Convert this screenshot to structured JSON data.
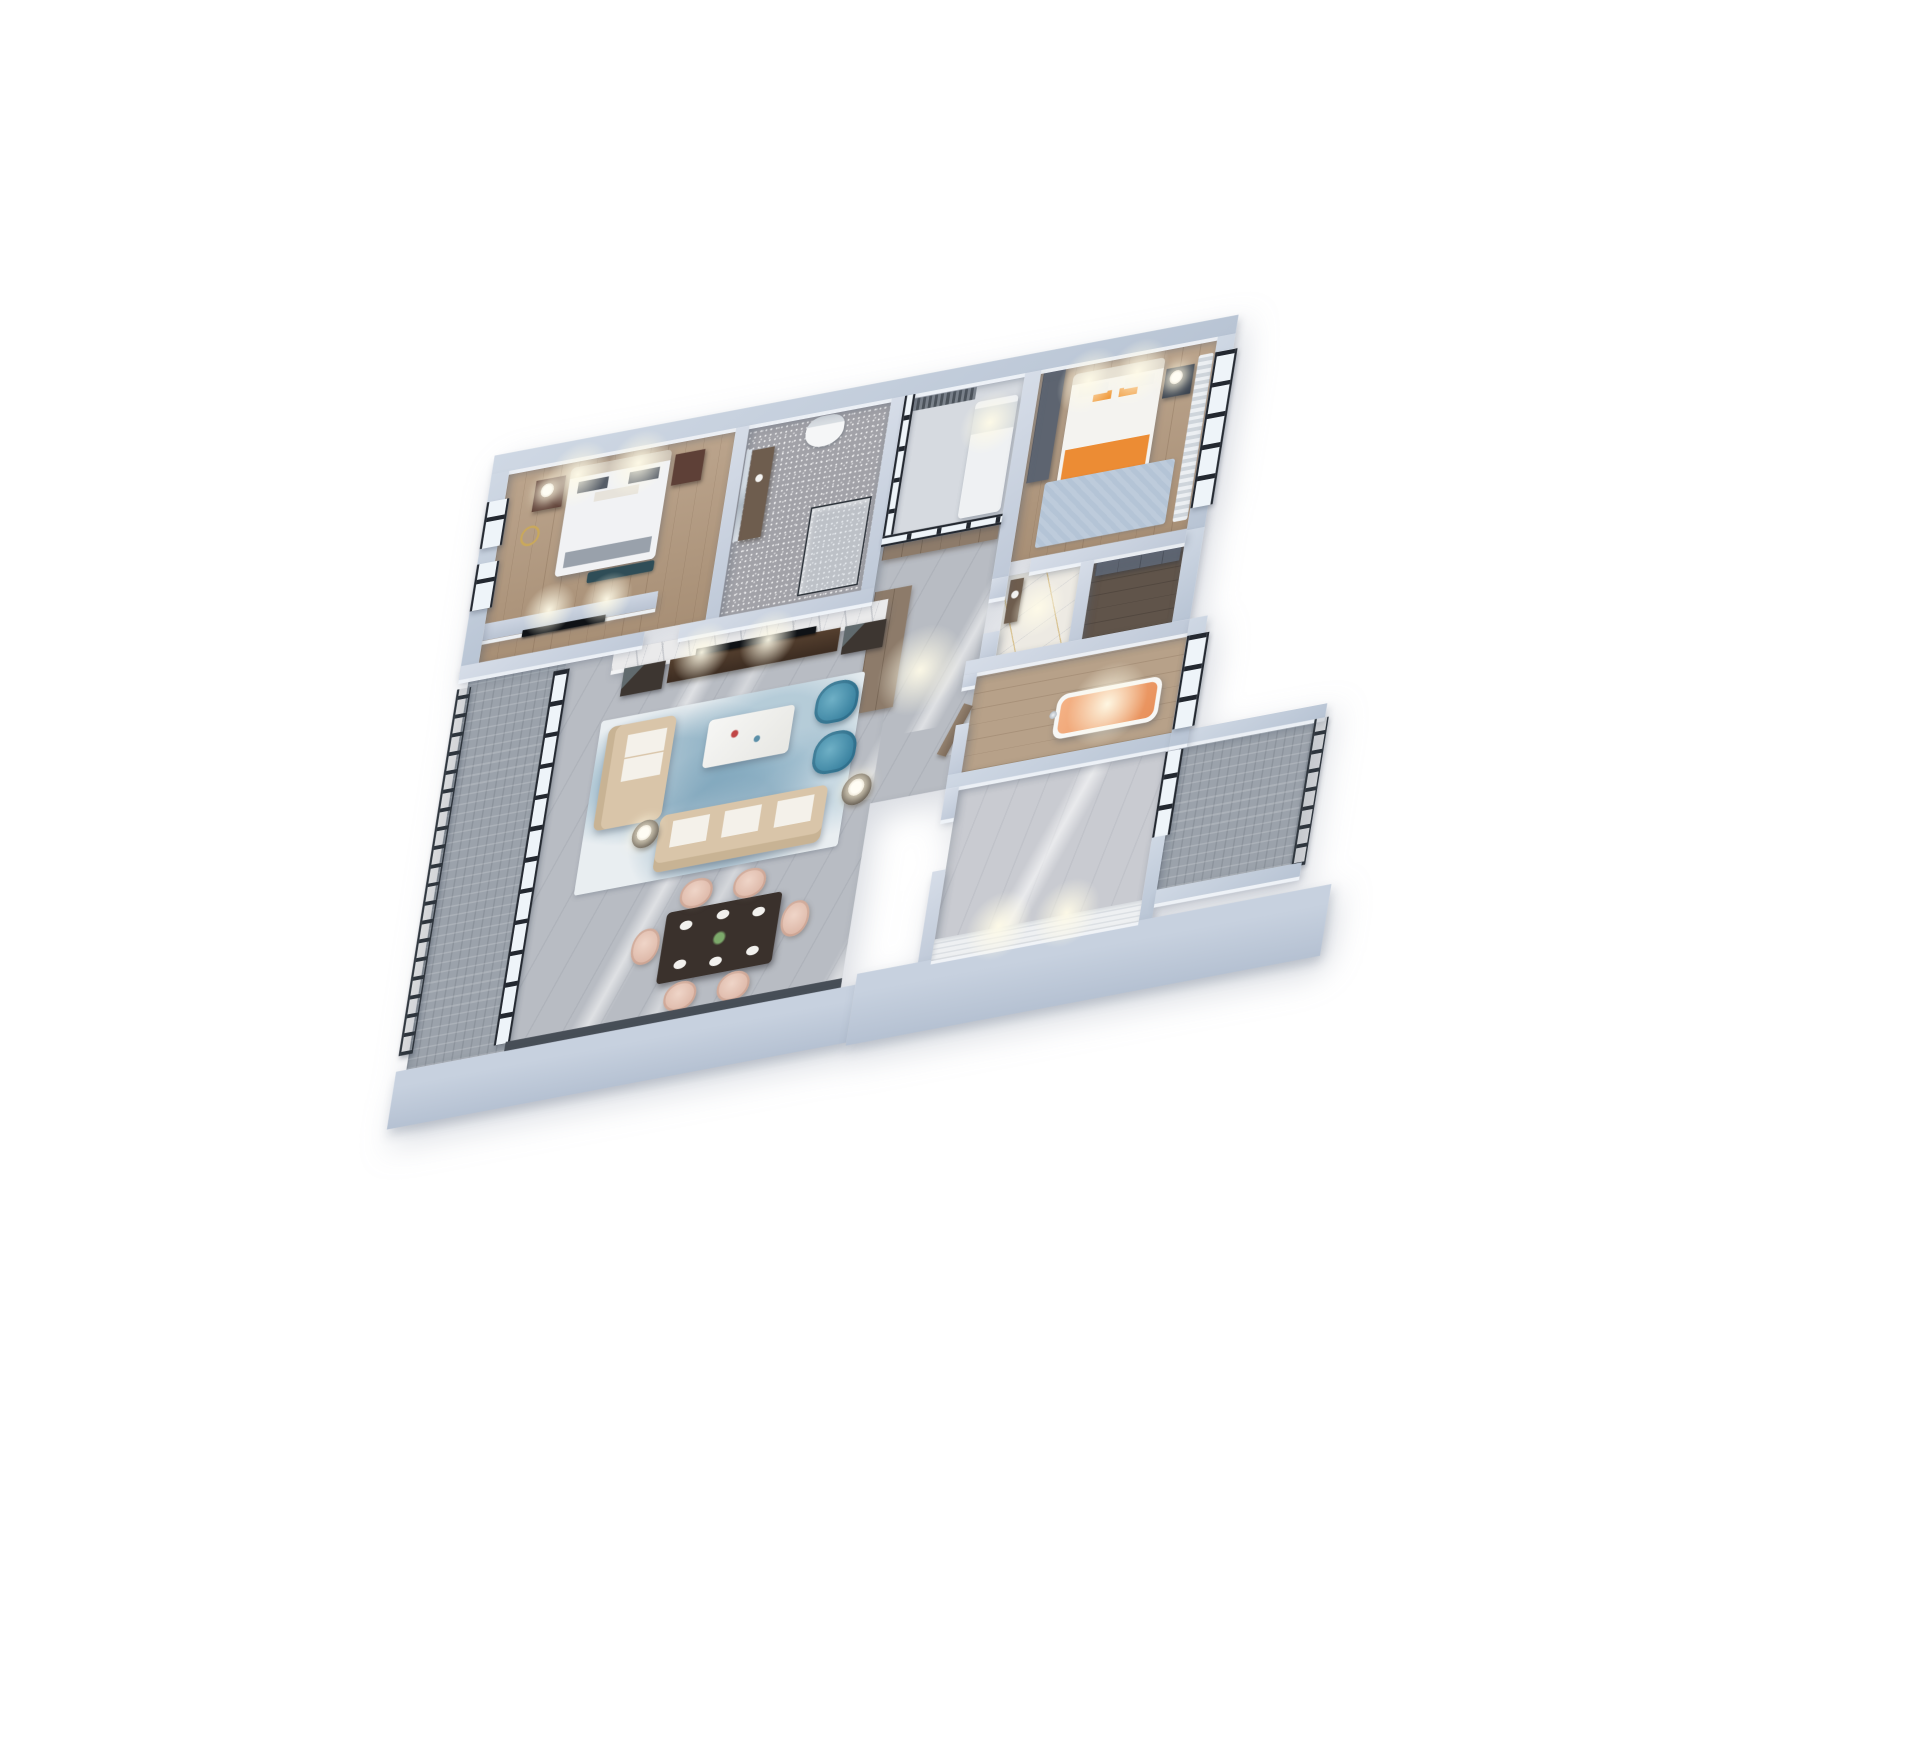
{
  "image": {
    "type": "3d-axonometric-floorplan-render",
    "background": "#ffffff"
  },
  "palette": {
    "wall_top": "#c6cfdc",
    "wall_exterior": "#bcc7d6",
    "facade": "#b9c4d5",
    "wood_floor": "#b2987d",
    "wood_floor_light": "#b7a189",
    "marble_grey": "#b8bcc3",
    "marble_light": "#c9cbd1",
    "marble_gold": "#edeae3",
    "tile_sparkle": "#a2a2a8",
    "tile_balcony": "#9ba2ab",
    "closet_dark": "#60544a",
    "railing": "#2e353d",
    "window_frame": "#232830",
    "glass": "#e8eef4",
    "sofa_beige": "#d9c5a9",
    "armchair_blue": "#4190ae",
    "dining_chair_blush": "#e6c8ba",
    "dining_table": "#3a312c",
    "coffee_table": "#f2f2f0",
    "tv_black": "#0f1216",
    "cabinet_brown": "#8d7b6a",
    "cabinet_dark": "#3d3631",
    "wardrobe_grey": "#5d6470",
    "nightstand_brown": "#5e4037",
    "bed_white": "#f1f2f4",
    "bedding_orange": "#ec8c34",
    "tub_orange": "#f0a471",
    "rug_blue": "#7fb3c9",
    "lamp_warm": "#fffdf4",
    "accent_wall": "#eef0f2",
    "doll_blue": "#3f6fc2",
    "gold_vein": "#c6a04a"
  },
  "scene": {
    "floors": [
      {
        "id": "floor-bedroom-west",
        "x": 64,
        "y": 64,
        "w": 306,
        "h": 246,
        "floor": "wood"
      },
      {
        "id": "floor-bathroom-north",
        "x": 388,
        "y": 64,
        "w": 192,
        "h": 246,
        "floor": "tile-sparkle"
      },
      {
        "id": "floor-study-glass-room",
        "x": 598,
        "y": 64,
        "w": 162,
        "h": 186,
        "floor": "light"
      },
      {
        "id": "floor-bedroom-east",
        "x": 782,
        "y": 64,
        "w": 238,
        "h": 246,
        "floor": "wood"
      },
      {
        "id": "floor-hallway",
        "x": 598,
        "y": 250,
        "w": 162,
        "h": 344,
        "floor": "marble-grey"
      },
      {
        "id": "floor-bathroom-gold",
        "x": 782,
        "y": 328,
        "w": 98,
        "h": 102,
        "floor": "marble-gold"
      },
      {
        "id": "floor-closet",
        "x": 898,
        "y": 328,
        "w": 122,
        "h": 102,
        "floor": "dark"
      },
      {
        "id": "floor-bathroom-tub",
        "x": 760,
        "y": 448,
        "w": 284,
        "h": 128,
        "floor": "wood-e"
      },
      {
        "id": "floor-bedroom-southeast",
        "x": 760,
        "y": 594,
        "w": 280,
        "h": 230,
        "floor": "marble-light"
      },
      {
        "id": "floor-living-dining",
        "x": 186,
        "y": 328,
        "w": 454,
        "h": 502,
        "floor": "marble-grey"
      },
      {
        "id": "floor-balcony-west",
        "x": 54,
        "y": 328,
        "w": 132,
        "h": 502,
        "floor": "tile-balcony"
      },
      {
        "id": "floor-balcony-southeast",
        "x": 1058,
        "y": 594,
        "w": 182,
        "h": 186,
        "floor": "tile-balcony"
      }
    ],
    "furniture": [
      {
        "id": "bed-master",
        "kind": "bed-white",
        "x": 150,
        "y": 76,
        "w": 136,
        "h": 140
      },
      {
        "id": "bench-bed-foot",
        "kind": "bench-teal",
        "x": 196,
        "y": 218,
        "w": 90,
        "h": 14
      },
      {
        "id": "nightstand-master-left",
        "kind": "nightstand",
        "x": 104,
        "y": 84,
        "w": 40,
        "h": 40
      },
      {
        "id": "nightstand-master-right",
        "kind": "nightstand",
        "x": 292,
        "y": 84,
        "w": 40,
        "h": 40
      },
      {
        "id": "lamp-master-left",
        "kind": "lamp",
        "x": 112,
        "y": 90,
        "w": 18,
        "h": 18
      },
      {
        "id": "decor-gold-ring-sculpture",
        "kind": "ring-gold",
        "x": 94,
        "y": 142,
        "w": 26,
        "h": 26
      },
      {
        "id": "tv-partition-master",
        "kind": "partition",
        "x": 64,
        "y": 260,
        "w": 234,
        "h": 22
      },
      {
        "id": "tv-master",
        "kind": "tv",
        "x": 118,
        "y": 278,
        "w": 112,
        "h": 9
      },
      {
        "id": "bathroom-mirror",
        "kind": "mirror",
        "x": 390,
        "y": 96,
        "w": 7,
        "h": 118
      },
      {
        "id": "bathroom-vanity",
        "kind": "vanity",
        "x": 398,
        "y": 98,
        "w": 30,
        "h": 116
      },
      {
        "id": "toilet",
        "kind": "toilet",
        "x": 468,
        "y": 70,
        "w": 52,
        "h": 40
      },
      {
        "id": "shower-enclosure",
        "kind": "shower",
        "x": 492,
        "y": 188,
        "w": 82,
        "h": 114
      },
      {
        "id": "study-blind",
        "kind": "curtain-dark",
        "x": 604,
        "y": 70,
        "w": 92,
        "h": 16
      },
      {
        "id": "study-daybed",
        "kind": "bed-small",
        "x": 698,
        "y": 90,
        "w": 58,
        "h": 150
      },
      {
        "id": "study-doll-blue",
        "kind": "doll",
        "x": 648,
        "y": 250,
        "w": 20,
        "h": 20
      },
      {
        "id": "wardrobe-bedroom-east",
        "kind": "wardrobe-grey",
        "x": 786,
        "y": 66,
        "w": 30,
        "h": 144
      },
      {
        "id": "bed-east-orange",
        "kind": "bed-orange",
        "x": 828,
        "y": 78,
        "w": 124,
        "h": 158
      },
      {
        "id": "rug-bedroom-east",
        "kind": "rug-plain",
        "x": 812,
        "y": 214,
        "w": 176,
        "h": 84
      },
      {
        "id": "nightstand-east",
        "kind": "nightstand-dark",
        "x": 956,
        "y": 94,
        "w": 38,
        "h": 38
      },
      {
        "id": "lamp-bedroom-east",
        "kind": "lamp",
        "x": 962,
        "y": 98,
        "w": 18,
        "h": 18
      },
      {
        "id": "curtain-bedroom-east",
        "kind": "curtain",
        "x": 998,
        "y": 84,
        "w": 20,
        "h": 214
      },
      {
        "id": "closet-wardrobe-unit",
        "kind": "wardrobe-grey",
        "x": 902,
        "y": 332,
        "w": 114,
        "h": 18
      },
      {
        "id": "entry-cabinet-north",
        "kind": "cabinet-brown",
        "x": 602,
        "y": 254,
        "w": 156,
        "h": 22
      },
      {
        "id": "entry-wardrobe-west",
        "kind": "cabinet-brown",
        "x": 600,
        "y": 316,
        "w": 50,
        "h": 156
      },
      {
        "id": "entry-door",
        "kind": "door",
        "x": 748,
        "y": 488,
        "w": 14,
        "h": 66
      },
      {
        "id": "vanity-gold-bath",
        "kind": "vanity",
        "x": 786,
        "y": 334,
        "w": 18,
        "h": 56
      },
      {
        "id": "freestanding-bathtub",
        "kind": "tub",
        "x": 878,
        "y": 498,
        "w": 142,
        "h": 58
      },
      {
        "id": "bathtub-faucet",
        "kind": "faucet",
        "x": 870,
        "y": 518,
        "w": 10,
        "h": 10
      },
      {
        "id": "living-marble-tv-wall",
        "kind": "marble-wall",
        "x": 250,
        "y": 328,
        "w": 370,
        "h": 26
      },
      {
        "id": "tv-console",
        "kind": "tv-console",
        "x": 330,
        "y": 354,
        "w": 230,
        "h": 30
      },
      {
        "id": "tv-living",
        "kind": "tv",
        "x": 364,
        "y": 346,
        "w": 162,
        "h": 9
      },
      {
        "id": "cabinet-glass-left",
        "kind": "cabinet-dark",
        "x": 268,
        "y": 354,
        "w": 56,
        "h": 36
      },
      {
        "id": "cabinet-glass-right",
        "kind": "cabinet-dark",
        "x": 566,
        "y": 354,
        "w": 56,
        "h": 36
      },
      {
        "id": "rug-living-abstract",
        "kind": "rug-abstract",
        "x": 248,
        "y": 418,
        "w": 356,
        "h": 224
      },
      {
        "id": "sofa-chaise",
        "kind": "sofa-beige",
        "x": 260,
        "y": 428,
        "w": 92,
        "h": 134
      },
      {
        "id": "sofa-long",
        "kind": "sofa-beige-h",
        "x": 352,
        "y": 558,
        "w": 226,
        "h": 74
      },
      {
        "id": "coffee-table",
        "kind": "table-white",
        "x": 398,
        "y": 444,
        "w": 116,
        "h": 62
      },
      {
        "id": "armchair-blue-a",
        "kind": "chair-blue",
        "x": 542,
        "y": 424,
        "w": 58,
        "h": 54
      },
      {
        "id": "armchair-blue-b",
        "kind": "chair-blue",
        "x": 550,
        "y": 490,
        "w": 58,
        "h": 54
      },
      {
        "id": "side-table-west",
        "kind": "side-table",
        "x": 316,
        "y": 560,
        "w": 36,
        "h": 36
      },
      {
        "id": "lamp-living-west",
        "kind": "lamp",
        "x": 322,
        "y": 566,
        "w": 20,
        "h": 20
      },
      {
        "id": "side-table-east",
        "kind": "side-table",
        "x": 598,
        "y": 552,
        "w": 40,
        "h": 40
      },
      {
        "id": "lamp-living-east",
        "kind": "lamp",
        "x": 606,
        "y": 558,
        "w": 22,
        "h": 22
      },
      {
        "id": "dining-table",
        "kind": "dining-table",
        "x": 382,
        "y": 688,
        "w": 156,
        "h": 92
      },
      {
        "id": "dining-chair-north-1",
        "kind": "chair-blush",
        "x": 396,
        "y": 650,
        "w": 44,
        "h": 38
      },
      {
        "id": "dining-chair-north-2",
        "kind": "chair-blush",
        "x": 468,
        "y": 650,
        "w": 44,
        "h": 38
      },
      {
        "id": "dining-chair-south-1",
        "kind": "chair-blush",
        "x": 396,
        "y": 782,
        "w": 44,
        "h": 38
      },
      {
        "id": "dining-chair-south-2",
        "kind": "chair-blush",
        "x": 468,
        "y": 782,
        "w": 44,
        "h": 38
      },
      {
        "id": "dining-chair-west",
        "kind": "chair-blush",
        "x": 340,
        "y": 704,
        "w": 38,
        "h": 46
      },
      {
        "id": "dining-chair-east",
        "kind": "chair-blush",
        "x": 542,
        "y": 704,
        "w": 38,
        "h": 46
      }
    ],
    "walls": [
      {
        "id": "wall-exterior-north",
        "x": 40,
        "y": 40,
        "w": 1004,
        "h": 24,
        "kind": "ext"
      },
      {
        "id": "wall-exterior-west",
        "x": 40,
        "y": 64,
        "w": 24,
        "h": 256,
        "kind": "ext"
      },
      {
        "id": "window-west-a",
        "x": 40,
        "y": 100,
        "w": 24,
        "h": 60,
        "kind": "window-v"
      },
      {
        "id": "window-west-b",
        "x": 40,
        "y": 180,
        "w": 24,
        "h": 60,
        "kind": "window-v"
      },
      {
        "id": "wall-exterior-east-upper",
        "x": 1020,
        "y": 64,
        "w": 24,
        "h": 248,
        "kind": "ext"
      },
      {
        "id": "window-east-bedroom",
        "x": 1020,
        "y": 84,
        "w": 24,
        "h": 200,
        "kind": "window-v"
      },
      {
        "id": "wall-exterior-east-mid",
        "x": 1020,
        "y": 312,
        "w": 24,
        "h": 118,
        "kind": "ext"
      },
      {
        "id": "wall-bedroomwest-bathroom",
        "x": 370,
        "y": 64,
        "w": 18,
        "h": 246,
        "kind": "int"
      },
      {
        "id": "wall-bathroom-study",
        "x": 580,
        "y": 64,
        "w": 18,
        "h": 246,
        "kind": "int"
      },
      {
        "id": "wall-study-bedroomeast",
        "x": 760,
        "y": 64,
        "w": 22,
        "h": 264,
        "kind": "int"
      },
      {
        "id": "glass-study-west",
        "x": 598,
        "y": 64,
        "w": 8,
        "h": 186,
        "kind": "window-v"
      },
      {
        "id": "glass-study-south",
        "x": 598,
        "y": 244,
        "w": 162,
        "h": 8,
        "kind": "window-h"
      },
      {
        "id": "wall-south-bedroomwest-a",
        "x": 40,
        "y": 310,
        "w": 248,
        "h": 18,
        "kind": "int"
      },
      {
        "id": "wall-south-bedroomwest-b",
        "x": 336,
        "y": 310,
        "w": 262,
        "h": 18,
        "kind": "int"
      },
      {
        "id": "wall-south-bedroomeast",
        "x": 810,
        "y": 310,
        "w": 210,
        "h": 18,
        "kind": "int"
      },
      {
        "id": "wall-closet-divider",
        "x": 880,
        "y": 328,
        "w": 18,
        "h": 102,
        "kind": "int"
      },
      {
        "id": "wall-hall-east-a",
        "x": 760,
        "y": 328,
        "w": 22,
        "h": 26,
        "kind": "int"
      },
      {
        "id": "wall-hall-east-b",
        "x": 760,
        "y": 398,
        "w": 22,
        "h": 32,
        "kind": "int"
      },
      {
        "id": "wall-tubroom-north",
        "x": 742,
        "y": 430,
        "w": 302,
        "h": 18,
        "kind": "int"
      },
      {
        "id": "wall-tubroom-west-a",
        "x": 742,
        "y": 448,
        "w": 18,
        "h": 16,
        "kind": "int"
      },
      {
        "id": "wall-tubroom-west-b",
        "x": 742,
        "y": 512,
        "w": 18,
        "h": 64,
        "kind": "int"
      },
      {
        "id": "wall-tubroom-south",
        "x": 742,
        "y": 576,
        "w": 322,
        "h": 18,
        "kind": "ext"
      },
      {
        "id": "wall-balcony-se-north",
        "x": 1064,
        "y": 576,
        "w": 190,
        "h": 18,
        "kind": "ext"
      },
      {
        "id": "wall-exterior-east-tub",
        "x": 1044,
        "y": 430,
        "w": 24,
        "h": 164,
        "kind": "ext"
      },
      {
        "id": "window-east-tubroom",
        "x": 1044,
        "y": 452,
        "w": 24,
        "h": 120,
        "kind": "window-v"
      },
      {
        "id": "wall-bedroom-se-west-a",
        "x": 742,
        "y": 594,
        "w": 18,
        "h": 40,
        "kind": "int"
      },
      {
        "id": "wall-bedroom-se-west-b",
        "x": 742,
        "y": 700,
        "w": 18,
        "h": 124,
        "kind": "int"
      },
      {
        "id": "window-bedroom-se-east",
        "x": 1040,
        "y": 600,
        "w": 18,
        "h": 110,
        "kind": "window-v"
      },
      {
        "id": "wall-bedroom-se-east",
        "x": 1040,
        "y": 710,
        "w": 18,
        "h": 114,
        "kind": "ext"
      },
      {
        "id": "railing-balcony-se",
        "x": 1240,
        "y": 594,
        "w": 14,
        "h": 190,
        "kind": "railing-v"
      },
      {
        "id": "wall-balcony-se-south",
        "x": 1058,
        "y": 780,
        "w": 196,
        "h": 18,
        "kind": "ext"
      },
      {
        "id": "railing-balcony-west",
        "x": 40,
        "y": 340,
        "w": 14,
        "h": 470,
        "kind": "railing-v"
      },
      {
        "id": "glass-doors-balcony-west",
        "x": 170,
        "y": 340,
        "w": 16,
        "h": 480,
        "kind": "window-v"
      },
      {
        "id": "door-frame-south-living",
        "x": 186,
        "y": 818,
        "w": 454,
        "h": 14,
        "kind": "frame-dark"
      },
      {
        "id": "facade-south-west",
        "x": 40,
        "y": 830,
        "w": 620,
        "h": 74,
        "kind": "facade"
      },
      {
        "id": "facade-south-east",
        "x": 660,
        "y": 816,
        "w": 640,
        "h": 92,
        "kind": "facade"
      },
      {
        "id": "accent-wall-bedroom-se",
        "x": 760,
        "y": 790,
        "w": 280,
        "h": 28,
        "kind": "accent"
      }
    ],
    "lights": [
      {
        "id": "spotlight-bedroom-west-a",
        "x": 160,
        "y": 86,
        "r": 44
      },
      {
        "id": "spotlight-bedroom-west-b",
        "x": 242,
        "y": 86,
        "r": 44
      },
      {
        "id": "spotlight-tv-partition-a",
        "x": 150,
        "y": 258,
        "r": 36
      },
      {
        "id": "spotlight-tv-partition-b",
        "x": 228,
        "y": 258,
        "r": 36
      },
      {
        "id": "spotlight-bedroom-east-a",
        "x": 850,
        "y": 90,
        "r": 44
      },
      {
        "id": "spotlight-bedroom-east-b",
        "x": 916,
        "y": 90,
        "r": 44
      },
      {
        "id": "spotlight-living-tvwall-a",
        "x": 372,
        "y": 352,
        "r": 40
      },
      {
        "id": "spotlight-living-tvwall-b",
        "x": 462,
        "y": 352,
        "r": 40
      },
      {
        "id": "spotlight-accent-wall-a",
        "x": 846,
        "y": 788,
        "r": 46
      },
      {
        "id": "spotlight-accent-wall-b",
        "x": 938,
        "y": 788,
        "r": 46
      },
      {
        "id": "glow-bathtub",
        "x": 948,
        "y": 522,
        "r": 56
      },
      {
        "id": "glow-study",
        "x": 722,
        "y": 120,
        "r": 42
      },
      {
        "id": "glow-hallway",
        "x": 680,
        "y": 430,
        "r": 60
      },
      {
        "id": "glow-bathroom-gold",
        "x": 830,
        "y": 378,
        "r": 38
      }
    ]
  }
}
